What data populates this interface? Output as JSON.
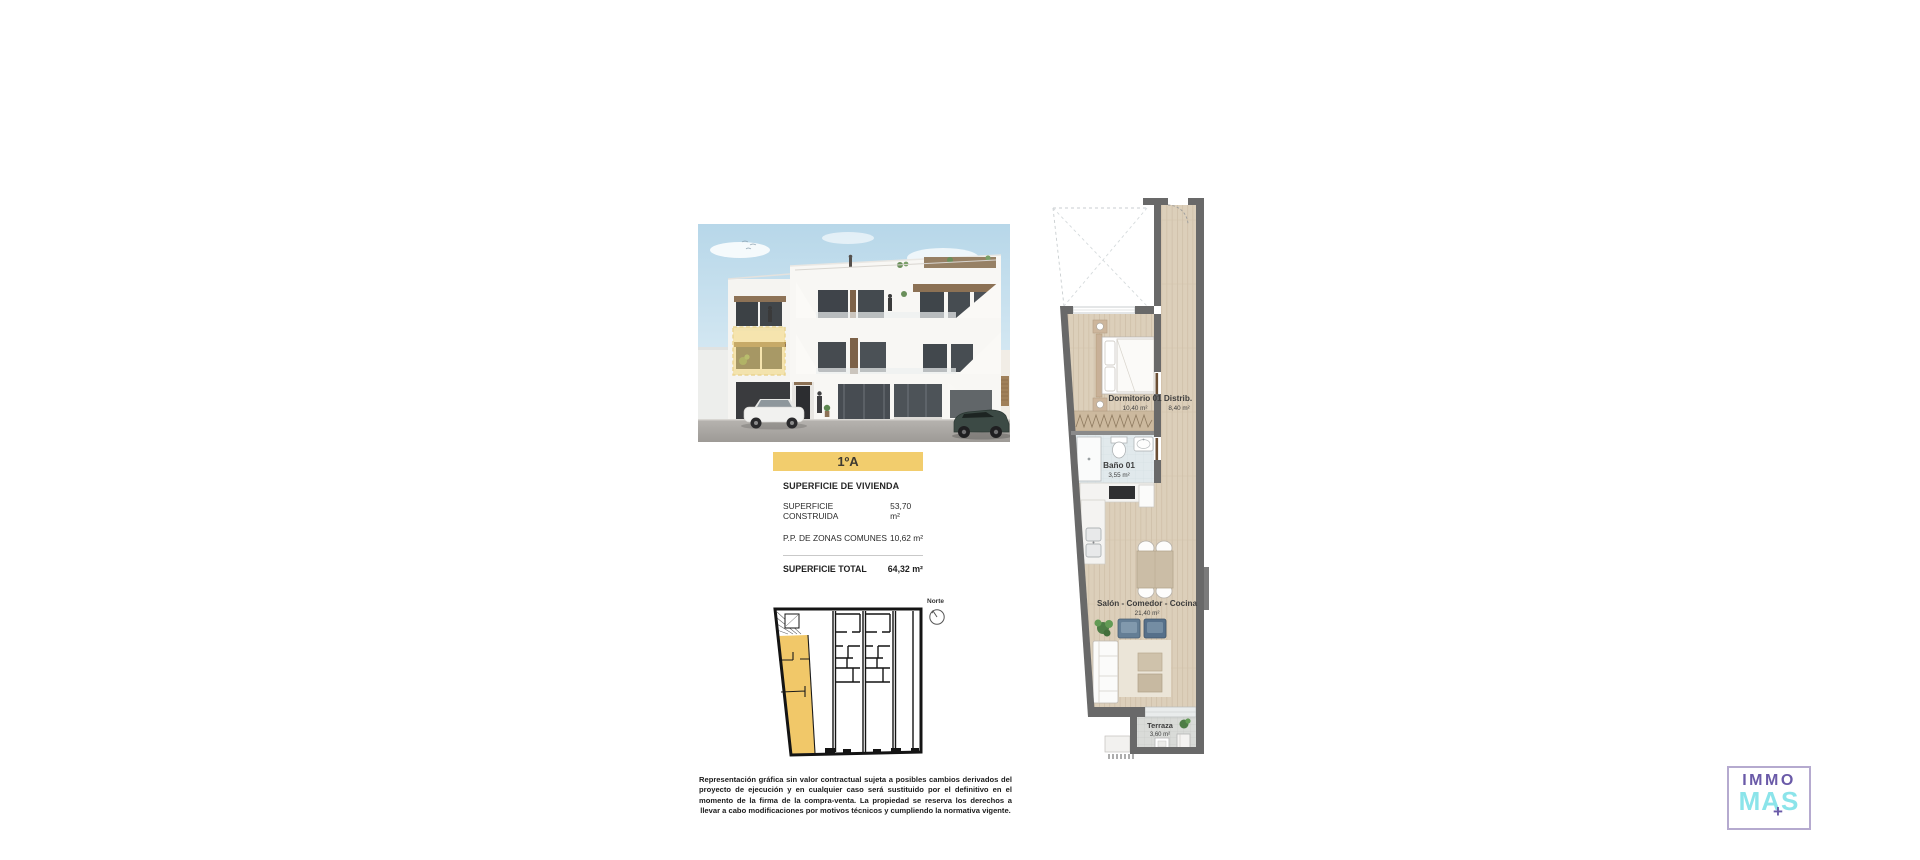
{
  "page": {
    "background": "#ffffff"
  },
  "brochure": {
    "unit_label": "1ºA",
    "surface": {
      "title": "SUPERFICIE DE VIVIENDA",
      "rows": [
        {
          "label": "SUPERFICIE CONSTRUIDA",
          "value": "53,70 m²"
        },
        {
          "label": "P.P. DE ZONAS COMUNES",
          "value": "10,62 m²"
        }
      ],
      "total_label": "SUPERFICIE TOTAL",
      "total_value": "64,32 m²"
    },
    "north_label": "Norte",
    "disclaimer": "Representación gráfica sin valor contractual sujeta a posibles cambios derivados del proyecto de ejecución y en cualquier caso será sustituido por el definitivo en el momento de la firma de la compra-venta. La propiedad se reserva los derechos a llevar a cabo modificaciones por motivos técnicos y cumpliendo la normativa vigente."
  },
  "floorplan": {
    "rooms": [
      {
        "name": "Dormitorio 01",
        "area": "10,40 m²"
      },
      {
        "name": "Distrib.",
        "area": "8,40 m²"
      },
      {
        "name": "Baño 01",
        "area": "3,55 m²"
      },
      {
        "name": "Salón - Comedor - Cocina",
        "area": "21,40 m²"
      },
      {
        "name": "Terraza",
        "area": "3,60 m²"
      }
    ]
  },
  "logo": {
    "top": "IMMO",
    "bottom": "MAS",
    "plus": "+"
  },
  "colors": {
    "accent_yellow": "#f2cd6d",
    "siteplan_yellow": "#f1c869",
    "wall_gray": "#696969",
    "wood_floor": "#dccfba",
    "logo_purple": "#6a5aa8",
    "logo_cyan": "#8be4ea"
  }
}
